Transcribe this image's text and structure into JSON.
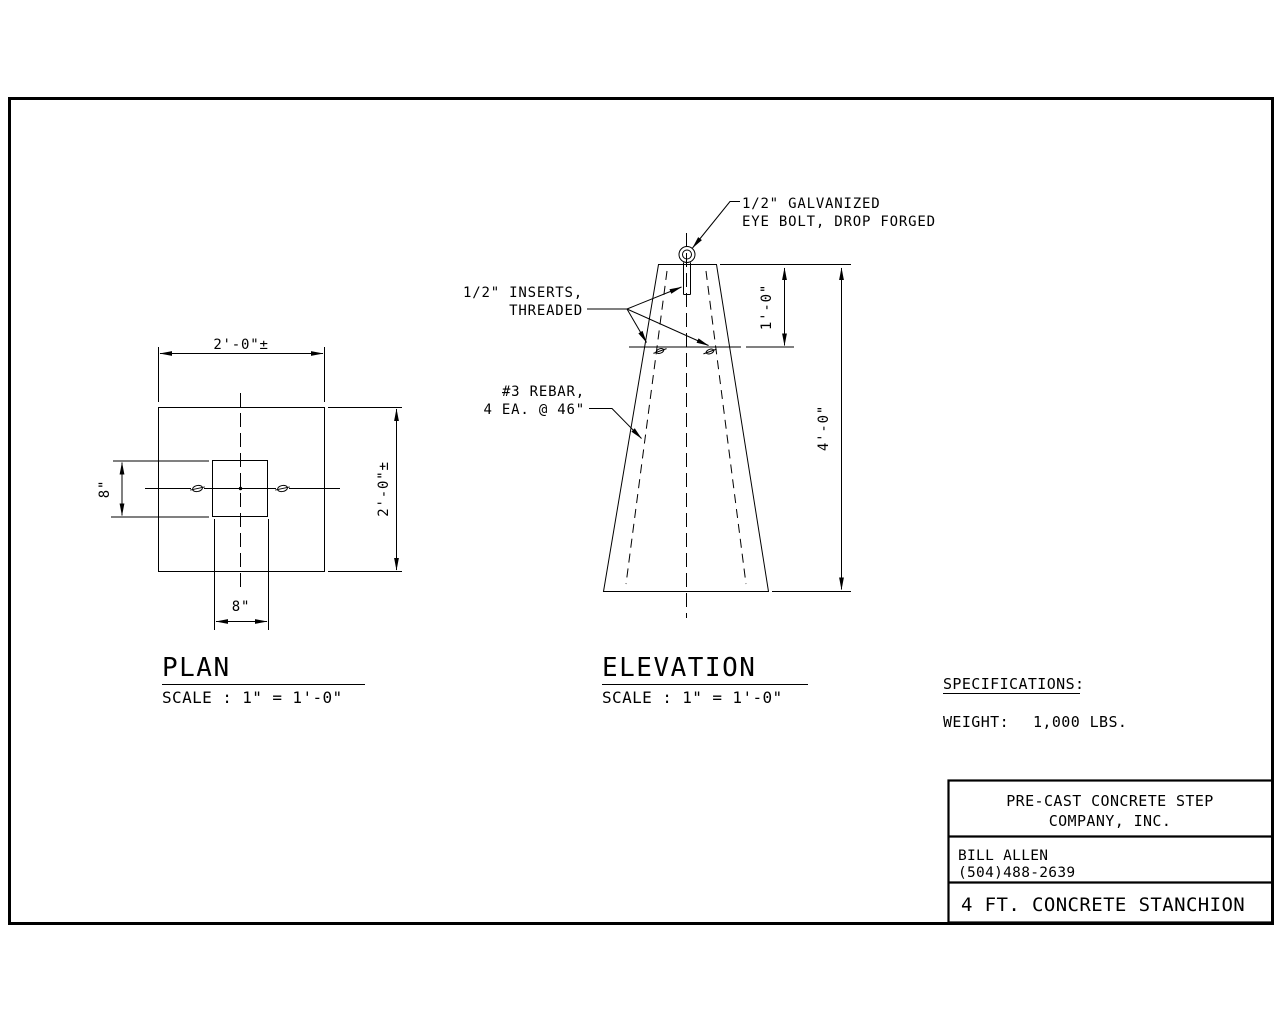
{
  "sheet": {
    "background_color": "#ffffff",
    "line_color": "#000000"
  },
  "plan_view": {
    "title": "PLAN",
    "scale_note": "SCALE : 1\" = 1'-0\"",
    "dims": {
      "width": "2'-0\"±",
      "height": "2'-0\"±",
      "core_width": "8\"",
      "core_height": "8\""
    }
  },
  "elevation_view": {
    "title": "ELEVATION",
    "scale_note": "SCALE : 1\" = 1'-0\"",
    "dims": {
      "insert_depth": "1'-0\"",
      "height": "4'-0\""
    },
    "annotations": {
      "eye_bolt_line1": "1/2\" GALVANIZED",
      "eye_bolt_line2": "EYE BOLT, DROP FORGED",
      "inserts_line1": "1/2\" INSERTS,",
      "inserts_line2": "THREADED",
      "rebar_line1": "#3 REBAR,",
      "rebar_line2": "4 EA. @ 46\""
    }
  },
  "specifications": {
    "heading": "SPECIFICATIONS:",
    "weight_label": "WEIGHT:",
    "weight_value": "1,000 LBS."
  },
  "title_block": {
    "company_line1": "PRE-CAST CONCRETE STEP",
    "company_line2": "COMPANY, INC.",
    "contact_name": "BILL ALLEN",
    "contact_phone": "(504)488-2639",
    "drawing_title": "4 FT. CONCRETE STANCHION"
  }
}
